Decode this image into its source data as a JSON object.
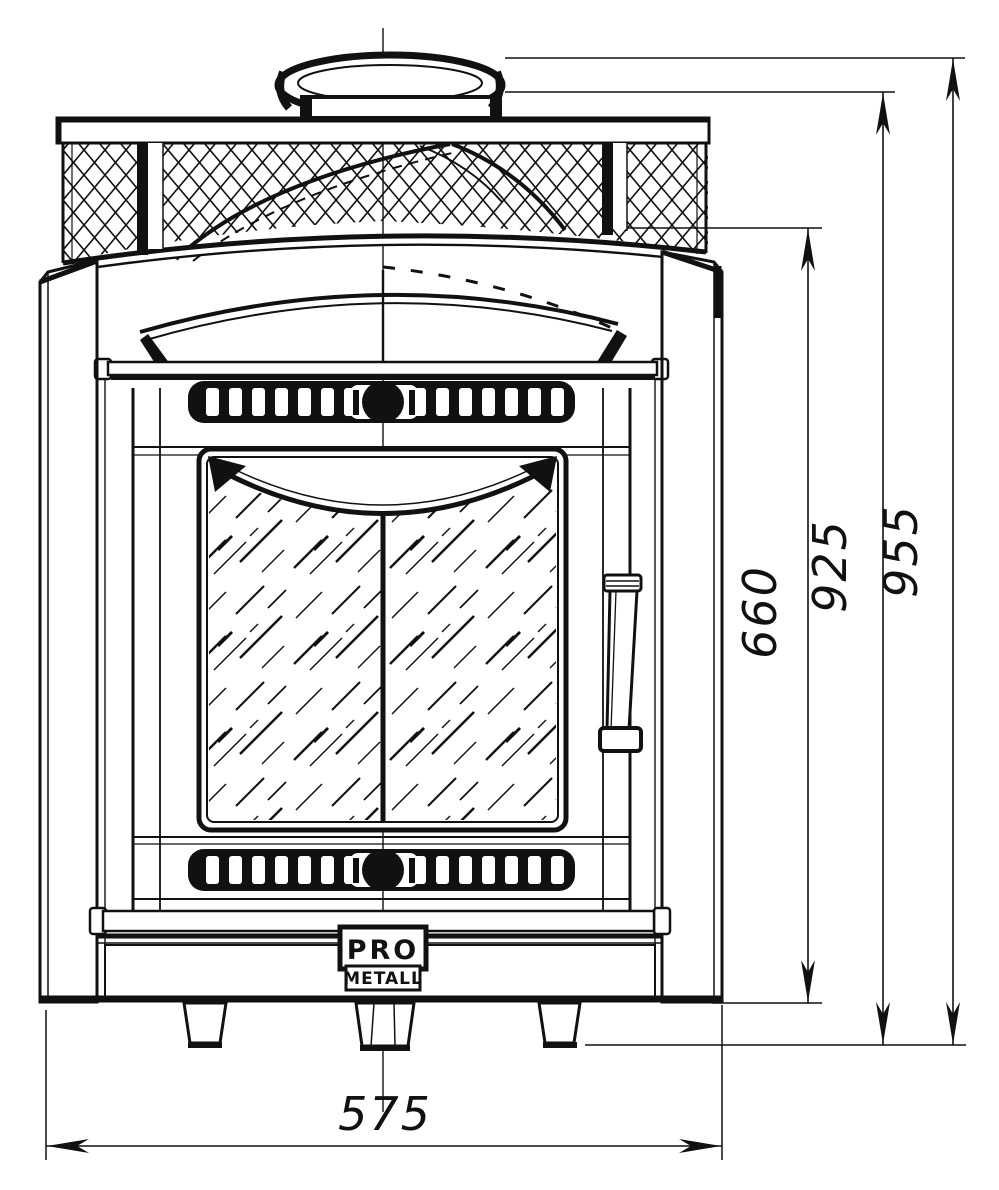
{
  "drawing": {
    "kind": "front-view technical line drawing",
    "subject": "wood-burning sauna stove with stone cage, glass door and chimney collar"
  },
  "colors": {
    "ink": "#111111",
    "paper": "#ffffff"
  },
  "logo": {
    "line1": "PRO",
    "line2": "METALL"
  },
  "dims": {
    "bottom_width": "575",
    "body_height": "660",
    "collar_base_height": "925",
    "total_height": "955"
  }
}
